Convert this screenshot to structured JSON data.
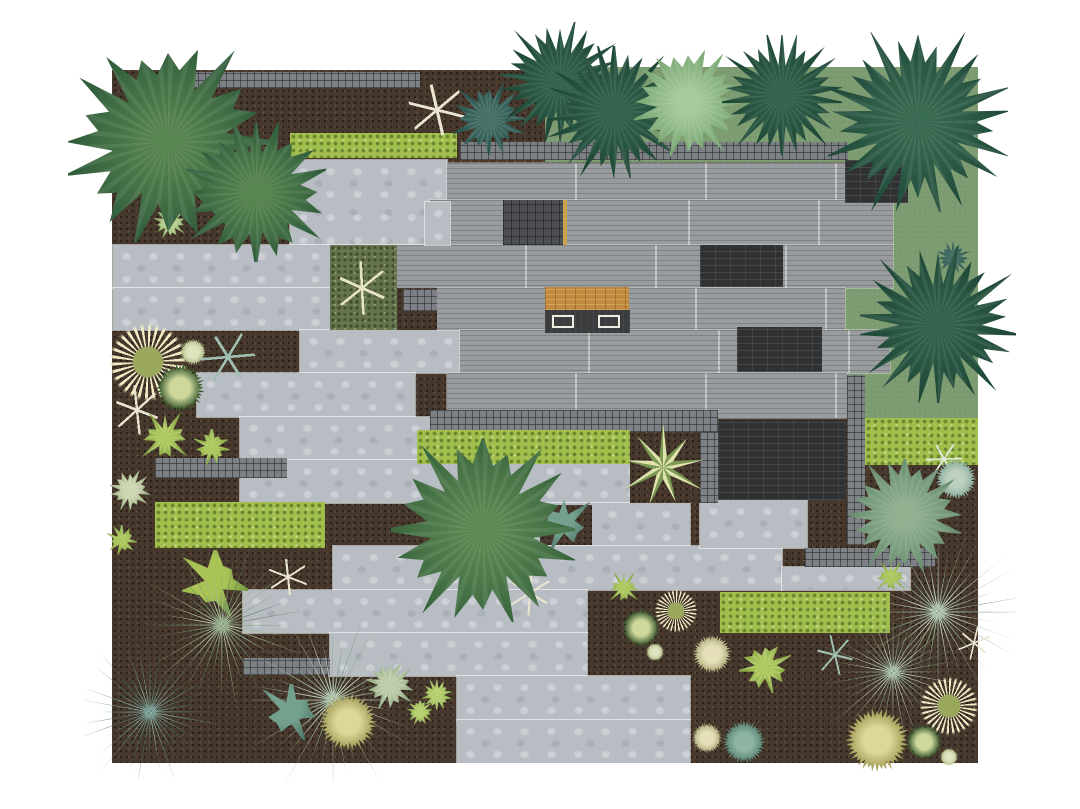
{
  "title": "Top-down landscape garden plan with house deck, stone paving, lawn, mulch beds and planting",
  "canvas": {
    "width": 1080,
    "height": 809,
    "background": "#ffffff"
  },
  "palette": {
    "mulch": "#46382c",
    "lawn": "#7c9b70",
    "concrete": "#b8bdc4",
    "roof_plank": "#999c9e",
    "dark_brick": "#2f3133",
    "cobble": "#7d8084",
    "hedge": "#a2bf4e",
    "moss": "#66754e",
    "wood_deck": "#c28a3f",
    "bench": "#efece2",
    "conifer": "#2f6049",
    "deciduous": "#54814d"
  },
  "layers": [
    {
      "n": "mulch-bed-base",
      "t": "mulch",
      "x": 112,
      "y": 70,
      "w": 866,
      "h": 693
    },
    {
      "n": "lawn-top",
      "t": "lawn",
      "x": 545,
      "y": 67,
      "w": 433,
      "h": 95
    },
    {
      "n": "lawn-right",
      "t": "lawn",
      "x": 845,
      "y": 162,
      "w": 133,
      "h": 256
    },
    {
      "n": "paving-slab-1",
      "t": "slab",
      "x": 290,
      "y": 160,
      "w": 157,
      "h": 85
    },
    {
      "n": "paving-slab-2",
      "t": "slab",
      "x": 113,
      "y": 245,
      "w": 334,
      "h": 43
    },
    {
      "n": "paving-slab-3",
      "t": "slab",
      "x": 113,
      "y": 288,
      "w": 227,
      "h": 42
    },
    {
      "n": "paving-slab-4",
      "t": "slab",
      "x": 300,
      "y": 330,
      "w": 165,
      "h": 43
    },
    {
      "n": "paving-slab-5",
      "t": "slab",
      "x": 197,
      "y": 373,
      "w": 218,
      "h": 44
    },
    {
      "n": "paving-slab-6",
      "t": "slab",
      "x": 240,
      "y": 417,
      "w": 230,
      "h": 43
    },
    {
      "n": "paving-slab-7",
      "t": "slab",
      "x": 240,
      "y": 460,
      "w": 390,
      "h": 43
    },
    {
      "n": "paving-slab-8",
      "t": "slab",
      "x": 437,
      "y": 503,
      "w": 253,
      "h": 43
    },
    {
      "n": "paving-slab-9",
      "t": "slab",
      "x": 333,
      "y": 546,
      "w": 449,
      "h": 44
    },
    {
      "n": "paving-slab-10",
      "t": "slab",
      "x": 243,
      "y": 590,
      "w": 344,
      "h": 43
    },
    {
      "n": "paving-slab-11",
      "t": "slab",
      "x": 330,
      "y": 633,
      "w": 257,
      "h": 43
    },
    {
      "n": "paving-slab-12",
      "t": "slab",
      "x": 457,
      "y": 676,
      "w": 233,
      "h": 44
    },
    {
      "n": "paving-slab-13",
      "t": "slab",
      "x": 457,
      "y": 720,
      "w": 233,
      "h": 43
    },
    {
      "n": "paving-slab-14",
      "t": "slab",
      "x": 700,
      "y": 500,
      "w": 107,
      "h": 48
    },
    {
      "n": "paving-slab-15",
      "t": "slab",
      "x": 782,
      "y": 567,
      "w": 128,
      "h": 23
    },
    {
      "n": "roof-deck-row-1",
      "t": "plank",
      "x": 447,
      "y": 163,
      "w": 401,
      "h": 37
    },
    {
      "n": "roof-deck-row-2",
      "t": "plank",
      "x": 430,
      "y": 200,
      "w": 463,
      "h": 45
    },
    {
      "n": "roof-deck-row-3",
      "t": "plank",
      "x": 397,
      "y": 245,
      "w": 496,
      "h": 43
    },
    {
      "n": "roof-deck-row-4",
      "t": "plank",
      "x": 437,
      "y": 288,
      "w": 408,
      "h": 42
    },
    {
      "n": "roof-deck-row-5",
      "t": "plank",
      "x": 460,
      "y": 330,
      "w": 430,
      "h": 43
    },
    {
      "n": "roof-deck-row-6",
      "t": "plank",
      "x": 447,
      "y": 373,
      "w": 400,
      "h": 45
    },
    {
      "n": "concrete-pad-small",
      "t": "slab",
      "x": 425,
      "y": 202,
      "w": 25,
      "h": 43
    },
    {
      "n": "skylight-dark-tile",
      "t": "tile",
      "x": 503,
      "y": 200,
      "w": 62,
      "h": 45
    },
    {
      "n": "skylight-trim",
      "t": "tanline",
      "x": 563,
      "y": 200,
      "w": 4,
      "h": 45
    },
    {
      "n": "wood-deck-entry",
      "t": "wood",
      "x": 545,
      "y": 287,
      "w": 84,
      "h": 23
    },
    {
      "n": "entry-shadow-pad",
      "t": "darkpad",
      "x": 545,
      "y": 310,
      "w": 85,
      "h": 23
    },
    {
      "n": "bench-left",
      "t": "bench",
      "x": 552,
      "y": 315,
      "w": 22,
      "h": 13
    },
    {
      "n": "bench-right",
      "t": "bench",
      "x": 598,
      "y": 315,
      "w": 22,
      "h": 13
    },
    {
      "n": "mulch-pocket-mosside",
      "t": "mulch",
      "x": 397,
      "y": 288,
      "w": 40,
      "h": 42
    },
    {
      "n": "moss-planter",
      "t": "moss",
      "x": 330,
      "y": 245,
      "w": 67,
      "h": 85
    },
    {
      "n": "cobble-square-moss",
      "t": "cobble",
      "x": 403,
      "y": 289,
      "w": 34,
      "h": 22
    },
    {
      "n": "brick-patch-upper",
      "t": "brick",
      "x": 700,
      "y": 245,
      "w": 83,
      "h": 42
    },
    {
      "n": "brick-patch-mid",
      "t": "brick",
      "x": 737,
      "y": 327,
      "w": 85,
      "h": 45
    },
    {
      "n": "brick-patch-topright",
      "t": "brick",
      "x": 845,
      "y": 160,
      "w": 63,
      "h": 43
    },
    {
      "n": "brick-patio",
      "t": "brick",
      "x": 718,
      "y": 420,
      "w": 127,
      "h": 80
    },
    {
      "n": "cobble-wall-topleft",
      "t": "cobble",
      "x": 170,
      "y": 72,
      "w": 250,
      "h": 16
    },
    {
      "n": "cobble-wall-house-top",
      "t": "cobble",
      "x": 460,
      "y": 142,
      "w": 388,
      "h": 18
    },
    {
      "n": "cobble-strip-center",
      "t": "cobble",
      "x": 430,
      "y": 410,
      "w": 288,
      "h": 22
    },
    {
      "n": "cobble-strip-patio-left",
      "t": "cobble",
      "x": 700,
      "y": 432,
      "w": 18,
      "h": 71
    },
    {
      "n": "cobble-strip-right-vertical",
      "t": "cobble",
      "x": 847,
      "y": 375,
      "w": 18,
      "h": 170
    },
    {
      "n": "cobble-strip-lower-right",
      "t": "cobble",
      "x": 805,
      "y": 548,
      "w": 130,
      "h": 19
    },
    {
      "n": "cobble-strip-left",
      "t": "cobble",
      "x": 155,
      "y": 458,
      "w": 132,
      "h": 20
    },
    {
      "n": "cobble-strip-bottomleft",
      "t": "cobble",
      "x": 243,
      "y": 658,
      "w": 87,
      "h": 17
    },
    {
      "n": "hedge-topleft",
      "t": "hedge",
      "x": 290,
      "y": 133,
      "w": 167,
      "h": 25
    },
    {
      "n": "hedge-left",
      "t": "hedge",
      "x": 155,
      "y": 502,
      "w": 170,
      "h": 46
    },
    {
      "n": "hedge-center",
      "t": "hedge",
      "x": 417,
      "y": 430,
      "w": 213,
      "h": 34
    },
    {
      "n": "hedge-right",
      "t": "hedge",
      "x": 865,
      "y": 418,
      "w": 113,
      "h": 47
    },
    {
      "n": "hedge-bottomright",
      "t": "hedge",
      "x": 720,
      "y": 592,
      "w": 170,
      "h": 41
    },
    {
      "n": "planter-cactus-pocket",
      "t": "mulch",
      "x": 630,
      "y": 432,
      "w": 70,
      "h": 71
    },
    {
      "n": "pricklypear-pocket",
      "t": "mulch",
      "x": 540,
      "y": 505,
      "w": 52,
      "h": 40
    }
  ],
  "plants": [
    {
      "n": "ring-plant-left",
      "t": "ring",
      "x": 148,
      "y": 362,
      "r": 40,
      "c1": "#efe9c4",
      "c2": "#9aa85e"
    },
    {
      "n": "pale-ball-left",
      "t": "ball",
      "x": 193,
      "y": 352,
      "r": 13,
      "c1": "#b9c48e",
      "c2": "#dfe3c0"
    },
    {
      "n": "dark-globe-left",
      "t": "ball",
      "x": 180,
      "y": 388,
      "r": 24,
      "c1": "#3c5b31",
      "c2": "#cdd89a"
    },
    {
      "n": "dead-twig-left-1",
      "t": "twig",
      "x": 137,
      "y": 410,
      "r": 22,
      "c1": "#e8e4d0"
    },
    {
      "n": "teal-twig-left",
      "t": "twig",
      "x": 228,
      "y": 357,
      "r": 24,
      "c1": "#9fc0b0"
    },
    {
      "n": "lime-clump-left-1",
      "t": "clump",
      "x": 165,
      "y": 437,
      "r": 24,
      "c1": "#a8c455",
      "c2": "#7a9c3c"
    },
    {
      "n": "lime-clump-left-2",
      "t": "clump",
      "x": 212,
      "y": 447,
      "r": 18,
      "c1": "#a8c455",
      "c2": "#7a9c3c"
    },
    {
      "n": "sage-rosette-left",
      "t": "rosette",
      "x": 130,
      "y": 490,
      "r": 20,
      "c1": "#c9d4ae",
      "c2": "#93a878"
    },
    {
      "n": "lime-clump-left-3",
      "t": "clump",
      "x": 122,
      "y": 540,
      "r": 15,
      "c1": "#a8c455",
      "c2": "#7a9c3c"
    },
    {
      "n": "rosette-under-tree",
      "t": "rosette",
      "x": 170,
      "y": 222,
      "r": 16,
      "c1": "#b8cf8e",
      "c2": "#7fa35c"
    },
    {
      "n": "teal-sprig-under-tree",
      "t": "bush",
      "x": 213,
      "y": 196,
      "r": 14,
      "c1": "#4e7a72",
      "c2": "#2d5850"
    },
    {
      "n": "lime-cactus-pads",
      "t": "pads",
      "x": 215,
      "y": 583,
      "r": 33,
      "c1": "#a9c355",
      "c2": "#6f9340"
    },
    {
      "n": "dead-twig-left-2",
      "t": "twig",
      "x": 288,
      "y": 577,
      "r": 18,
      "c1": "#e8e4d0"
    },
    {
      "n": "dead-twig-center",
      "t": "twig",
      "x": 530,
      "y": 593,
      "r": 20,
      "c1": "#e8e4d0"
    },
    {
      "n": "olive-yucca-left",
      "t": "yucca",
      "x": 222,
      "y": 625,
      "r": 78,
      "c1": "#9cb489",
      "c2": "#5d7a58"
    },
    {
      "n": "blue-agave-left",
      "t": "yucca",
      "x": 150,
      "y": 712,
      "r": 66,
      "c1": "#6f9d92",
      "c2": "#3f6e63"
    },
    {
      "n": "pale-yucca-bottomleft",
      "t": "yucca",
      "x": 333,
      "y": 700,
      "r": 82,
      "c1": "#b3c8af",
      "c2": "#7b997a"
    },
    {
      "n": "straw-ball-bottomleft",
      "t": "ball",
      "x": 348,
      "y": 722,
      "r": 28,
      "c1": "#a8a25e",
      "c2": "#ded898"
    },
    {
      "n": "pricklypear-bottomleft",
      "t": "pads",
      "x": 291,
      "y": 712,
      "r": 28,
      "c1": "#74a08e",
      "c2": "#4a7463"
    },
    {
      "n": "sage-cluster-pocket",
      "t": "rosette",
      "x": 390,
      "y": 685,
      "r": 24,
      "c1": "#b9c9a4",
      "c2": "#8aa37e"
    },
    {
      "n": "lime-rosette-pocket-1",
      "t": "rosette",
      "x": 437,
      "y": 695,
      "r": 15,
      "c1": "#b2cc66",
      "c2": "#82a441"
    },
    {
      "n": "lime-rosette-pocket-2",
      "t": "rosette",
      "x": 420,
      "y": 712,
      "r": 13,
      "c1": "#b2cc66",
      "c2": "#82a441"
    },
    {
      "n": "pricklypear-center",
      "t": "pads",
      "x": 564,
      "y": 523,
      "r": 26,
      "c1": "#74a08e",
      "c2": "#4a7463"
    },
    {
      "n": "striped-cactus-planter",
      "t": "cactusstar",
      "x": 663,
      "y": 467,
      "r": 42,
      "c1": "#dfe3ae",
      "c2": "#7d9a55"
    },
    {
      "n": "ring-plant-mid",
      "t": "ring",
      "x": 676,
      "y": 611,
      "r": 22,
      "c1": "#efe9c4",
      "c2": "#9aa85e"
    },
    {
      "n": "dark-globe-mid",
      "t": "ball",
      "x": 641,
      "y": 628,
      "r": 19,
      "c1": "#3c5b31",
      "c2": "#cdd89a"
    },
    {
      "n": "pale-ball-mid",
      "t": "ball",
      "x": 655,
      "y": 652,
      "r": 9,
      "c1": "#b9c48e",
      "c2": "#dfe3c0"
    },
    {
      "n": "lime-clump-mid",
      "t": "clump",
      "x": 624,
      "y": 588,
      "r": 15,
      "c1": "#a8c455",
      "c2": "#7a9c3c"
    },
    {
      "n": "cream-ball-br-1",
      "t": "ball",
      "x": 712,
      "y": 654,
      "r": 19,
      "c1": "#b5b183",
      "c2": "#e5e0ba"
    },
    {
      "n": "cream-ball-br-2",
      "t": "ball",
      "x": 707,
      "y": 738,
      "r": 15,
      "c1": "#b5b183",
      "c2": "#e5e0ba"
    },
    {
      "n": "teal-ball-br",
      "t": "ball",
      "x": 744,
      "y": 742,
      "r": 21,
      "c1": "#5c8877",
      "c2": "#8fb4a4"
    },
    {
      "n": "lime-branch-br",
      "t": "clump",
      "x": 765,
      "y": 667,
      "r": 26,
      "c1": "#a8c455",
      "c2": "#7a9c3c"
    },
    {
      "n": "teal-twig-br",
      "t": "twig",
      "x": 835,
      "y": 655,
      "r": 18,
      "c1": "#9fc0b0"
    },
    {
      "n": "pale-yucca-br-1",
      "t": "yucca",
      "x": 938,
      "y": 612,
      "r": 78,
      "c1": "#b3c8af",
      "c2": "#7b997a"
    },
    {
      "n": "pale-yucca-br-2",
      "t": "yucca",
      "x": 893,
      "y": 672,
      "r": 68,
      "c1": "#aac2a6",
      "c2": "#6f8f70"
    },
    {
      "n": "ring-plant-br",
      "t": "ring",
      "x": 949,
      "y": 706,
      "r": 30,
      "c1": "#efe9c4",
      "c2": "#9aa85e"
    },
    {
      "n": "straw-ball-br",
      "t": "ball",
      "x": 877,
      "y": 740,
      "r": 31,
      "c1": "#a8a25e",
      "c2": "#ded898"
    },
    {
      "n": "dark-globe-br",
      "t": "ball",
      "x": 924,
      "y": 742,
      "r": 18,
      "c1": "#3c5b31",
      "c2": "#cdd89a"
    },
    {
      "n": "pale-ball-br",
      "t": "ball",
      "x": 949,
      "y": 757,
      "r": 9,
      "c1": "#b9c48e",
      "c2": "#dfe3c0"
    },
    {
      "n": "lime-clump-br",
      "t": "clump",
      "x": 891,
      "y": 577,
      "r": 15,
      "c1": "#a8c455",
      "c2": "#7a9c3c"
    },
    {
      "n": "dead-twig-br",
      "t": "twig",
      "x": 974,
      "y": 643,
      "r": 15,
      "c1": "#e8e4d0"
    },
    {
      "n": "dead-branch-topcenter",
      "t": "twig",
      "x": 437,
      "y": 110,
      "r": 26,
      "c1": "#e8e4d0"
    },
    {
      "n": "moss-planter-sketch",
      "t": "twig",
      "x": 362,
      "y": 288,
      "r": 24,
      "c1": "#e5e2c6"
    },
    {
      "n": "white-sprig-right",
      "t": "twig",
      "x": 944,
      "y": 459,
      "r": 16,
      "c1": "#dfe8da"
    },
    {
      "n": "pale-teal-ball-right",
      "t": "ball",
      "x": 956,
      "y": 479,
      "r": 20,
      "c1": "#8fb0a0",
      "c2": "#bccfc0"
    },
    {
      "n": "sage-tree-right",
      "t": "tree",
      "x": 905,
      "y": 515,
      "r": 56,
      "c1": "#8fae8e",
      "c2": "#678d6f"
    },
    {
      "n": "teal-bush-topcenter",
      "t": "bush",
      "x": 489,
      "y": 119,
      "r": 36,
      "c1": "#3f6a62",
      "c2": "#26514b"
    },
    {
      "n": "teal-bush-right",
      "t": "bush",
      "x": 953,
      "y": 258,
      "r": 16,
      "c1": "#3f6a62",
      "c2": "#26514b"
    },
    {
      "n": "deciduous-tree-topleft-a",
      "t": "tree",
      "x": 168,
      "y": 142,
      "r": 100,
      "c1": "#54814d",
      "c2": "#2f5c3b"
    },
    {
      "n": "deciduous-tree-topleft-b",
      "t": "tree",
      "x": 256,
      "y": 192,
      "r": 70,
      "c1": "#54814d",
      "c2": "#2f5c3b"
    },
    {
      "n": "deciduous-tree-center",
      "t": "tree",
      "x": 483,
      "y": 530,
      "r": 92,
      "c1": "#5c8552",
      "c2": "#39663e"
    },
    {
      "n": "conifer-top-1",
      "t": "conifer",
      "x": 560,
      "y": 82,
      "r": 60,
      "c1": "#2f6049",
      "c2": "#1c4434"
    },
    {
      "n": "conifer-top-2",
      "t": "conifer",
      "x": 614,
      "y": 112,
      "r": 66,
      "c1": "#2f6049",
      "c2": "#1c4434"
    },
    {
      "n": "light-tree-top",
      "t": "tree",
      "x": 688,
      "y": 102,
      "r": 54,
      "c1": "#a5c89b",
      "c2": "#76a46f"
    },
    {
      "n": "conifer-top-3",
      "t": "conifer",
      "x": 782,
      "y": 95,
      "r": 60,
      "c1": "#2f6049",
      "c2": "#1c4434"
    },
    {
      "n": "conifer-topright",
      "t": "conifer",
      "x": 918,
      "y": 122,
      "r": 90,
      "c1": "#35674f",
      "c2": "#1f4938"
    },
    {
      "n": "conifer-midright",
      "t": "conifer",
      "x": 938,
      "y": 325,
      "r": 78,
      "c1": "#2f6049",
      "c2": "#1c4434"
    }
  ]
}
